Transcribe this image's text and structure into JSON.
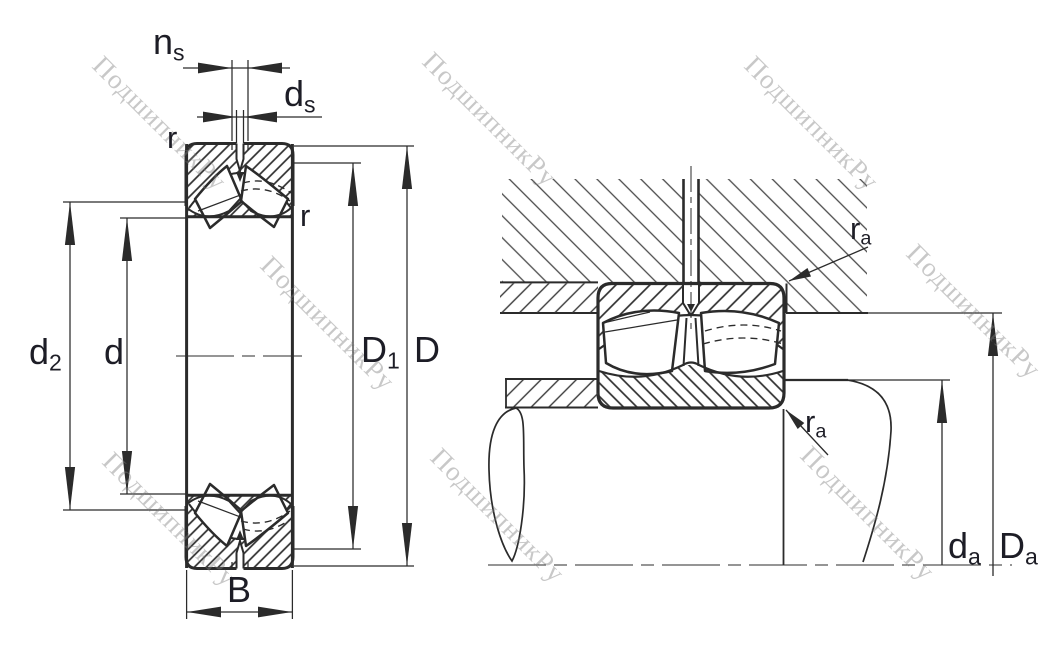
{
  "drawing": {
    "title": "Spherical roller bearing — dimension drawing and abutment/mounting drawing",
    "left_view": "bearing cross-section with boundary dimensions",
    "right_view": "bearing mounted in housing and on shaft (abutment dimensions)"
  },
  "labels": {
    "ns": {
      "main": "n",
      "sub": "s"
    },
    "ds": {
      "main": "d",
      "sub": "s"
    },
    "r_outer": {
      "main": "r",
      "sub": ""
    },
    "r_inner": {
      "main": "r",
      "sub": ""
    },
    "d2": {
      "main": "d",
      "sub": "2"
    },
    "d": {
      "main": "d",
      "sub": ""
    },
    "D1": {
      "main": "D",
      "sub": "1"
    },
    "D": {
      "main": "D",
      "sub": ""
    },
    "B": {
      "main": "B",
      "sub": ""
    },
    "ra_top": {
      "main": "r",
      "sub": "a"
    },
    "ra_bottom": {
      "main": "r",
      "sub": "a"
    },
    "da": {
      "main": "d",
      "sub": "a"
    },
    "Da": {
      "main": "D",
      "sub": "a"
    }
  },
  "watermark": {
    "text": "ПодшипникРу",
    "color": "#bdbdbd"
  },
  "colors": {
    "line": "#2b2b2b",
    "label": "#1d1d26",
    "background": "#ffffff"
  }
}
